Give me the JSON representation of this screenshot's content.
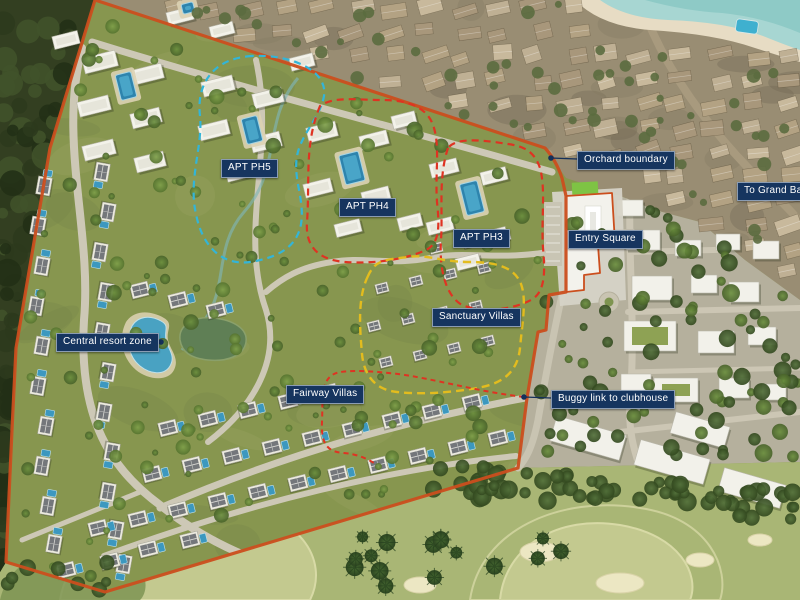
{
  "map": {
    "title": "Resort master plan aerial view",
    "annotations": [
      {
        "id": "orchard-boundary",
        "text": "Orchard boundary",
        "has_leader": true
      },
      {
        "id": "to-grand-baie",
        "text": "To Grand Baie",
        "has_leader": false
      },
      {
        "id": "entry-square",
        "text": "Entry Square",
        "has_leader": false
      },
      {
        "id": "apt-ph5",
        "text": "APT PH5",
        "has_leader": false
      },
      {
        "id": "apt-ph4",
        "text": "APT PH4",
        "has_leader": false
      },
      {
        "id": "apt-ph3",
        "text": "APT PH3",
        "has_leader": false
      },
      {
        "id": "sanctuary-villas",
        "text": "Sanctuary Villas",
        "has_leader": false
      },
      {
        "id": "central-resort-zone",
        "text": "Central resort zone",
        "has_leader": true
      },
      {
        "id": "fairway-villas",
        "text": "Fairway Villas",
        "has_leader": false
      },
      {
        "id": "buggy-link-to-clubhouse",
        "text": "Buggy link to clubhouse",
        "has_leader": true
      }
    ],
    "legend_colors": {
      "label_background": "#16355f",
      "label_text": "#ffffff",
      "site_boundary": "#cb4e1d",
      "phase_boundary_red": "#df3322",
      "phase_boundary_cyan": "#33b5d8",
      "phase_boundary_yellow": "#e3bc1e",
      "leader_line": "#14305a"
    }
  }
}
